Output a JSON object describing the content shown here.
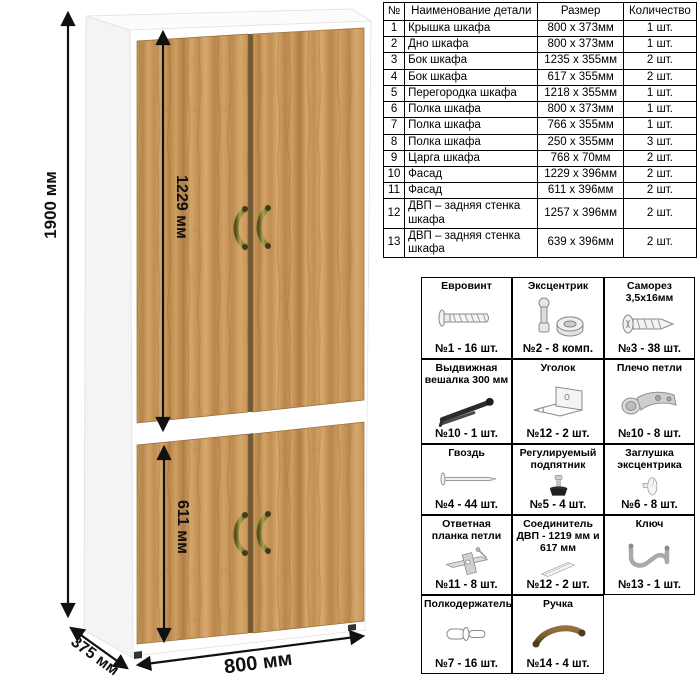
{
  "dimensions": {
    "height": "1900 мм",
    "upper_door_height": "1229 мм",
    "lower_door_height": "611 мм",
    "width": "800 мм",
    "depth": "375 мм"
  },
  "parts_table": {
    "headers": {
      "num": "№",
      "name": "Наименование детали",
      "size": "Размер",
      "qty": "Количество"
    },
    "rows": [
      {
        "num": "1",
        "name": "Крышка шкафа",
        "size": "800 х 373мм",
        "qty": "1 шт."
      },
      {
        "num": "2",
        "name": "Дно шкафа",
        "size": "800 х 373мм",
        "qty": "1 шт."
      },
      {
        "num": "3",
        "name": "Бок шкафа",
        "size": "1235 х 355мм",
        "qty": "2 шт."
      },
      {
        "num": "4",
        "name": "Бок шкафа",
        "size": "617 х 355мм",
        "qty": "2 шт."
      },
      {
        "num": "5",
        "name": "Перегородка шкафа",
        "size": "1218 х 355мм",
        "qty": "1 шт."
      },
      {
        "num": "6",
        "name": "Полка шкафа",
        "size": "800 х 373мм",
        "qty": "1 шт."
      },
      {
        "num": "7",
        "name": "Полка шкафа",
        "size": "766 х 355мм",
        "qty": "1 шт."
      },
      {
        "num": "8",
        "name": "Полка шкафа",
        "size": "250 х 355мм",
        "qty": "3 шт."
      },
      {
        "num": "9",
        "name": "Царга шкафа",
        "size": "768 х 70мм",
        "qty": "2 шт."
      },
      {
        "num": "10",
        "name": "Фасад",
        "size": "1229 х 396мм",
        "qty": "2 шт."
      },
      {
        "num": "11",
        "name": "Фасад",
        "size": "611 х 396мм",
        "qty": "2 шт."
      },
      {
        "num": "12",
        "name": "ДВП – задняя стенка шкафа",
        "size": "1257 х 396мм",
        "qty": "2 шт."
      },
      {
        "num": "13",
        "name": "ДВП – задняя стенка шкафа",
        "size": "639 х 396мм",
        "qty": "2 шт."
      }
    ]
  },
  "hardware": {
    "items": [
      {
        "title": "Евровинт",
        "count": "№1 - 16 шт.",
        "icon": "confirmat-screw-icon"
      },
      {
        "title": "Эксцентрик",
        "count": "№2 - 8 комп.",
        "icon": "cam-lock-icon"
      },
      {
        "title": "Саморез 3,5х16мм",
        "count": "№3 - 38 шт.",
        "icon": "self-tapping-screw-icon"
      },
      {
        "title": "Выдвижная вешалка 300 мм",
        "count": "№10 - 1 шт.",
        "icon": "pullout-hanger-icon"
      },
      {
        "title": "Уголок",
        "count": "№12 - 2 шт.",
        "icon": "corner-bracket-icon"
      },
      {
        "title": "Плечо петли",
        "count": "№10 - 8 шт.",
        "icon": "hinge-arm-icon"
      },
      {
        "title": "Гвоздь",
        "count": "№4 - 44 шт.",
        "icon": "nail-icon"
      },
      {
        "title": "Регулируемый подпятник",
        "count": "№5 - 4 шт.",
        "icon": "adjustable-foot-icon"
      },
      {
        "title": "Заглушка эксцентрика",
        "count": "№6 - 8 шт.",
        "icon": "cam-cover-icon"
      },
      {
        "title": "Ответная планка петли",
        "count": "№11 - 8 шт.",
        "icon": "hinge-plate-icon"
      },
      {
        "title": "Соединитель ДВП - 1219 мм и 617 мм",
        "count": "№12 - 2 шт.",
        "icon": "hdf-connector-icon"
      },
      {
        "title": "Ключ",
        "count": "№13 - 1 шт.",
        "icon": "hex-key-icon"
      },
      {
        "title": "Полкодержатель",
        "count": "№7 - 16 шт.",
        "icon": "shelf-pin-icon"
      },
      {
        "title": "Ручка",
        "count": "№14 - 4 шт.",
        "icon": "handle-icon"
      }
    ]
  },
  "colors": {
    "wood_base": "#c9975c",
    "wood_dark": "#a87c44",
    "handle_bronze": "#8a8a3f",
    "dimension_line": "#111111",
    "table_border": "#000000"
  }
}
